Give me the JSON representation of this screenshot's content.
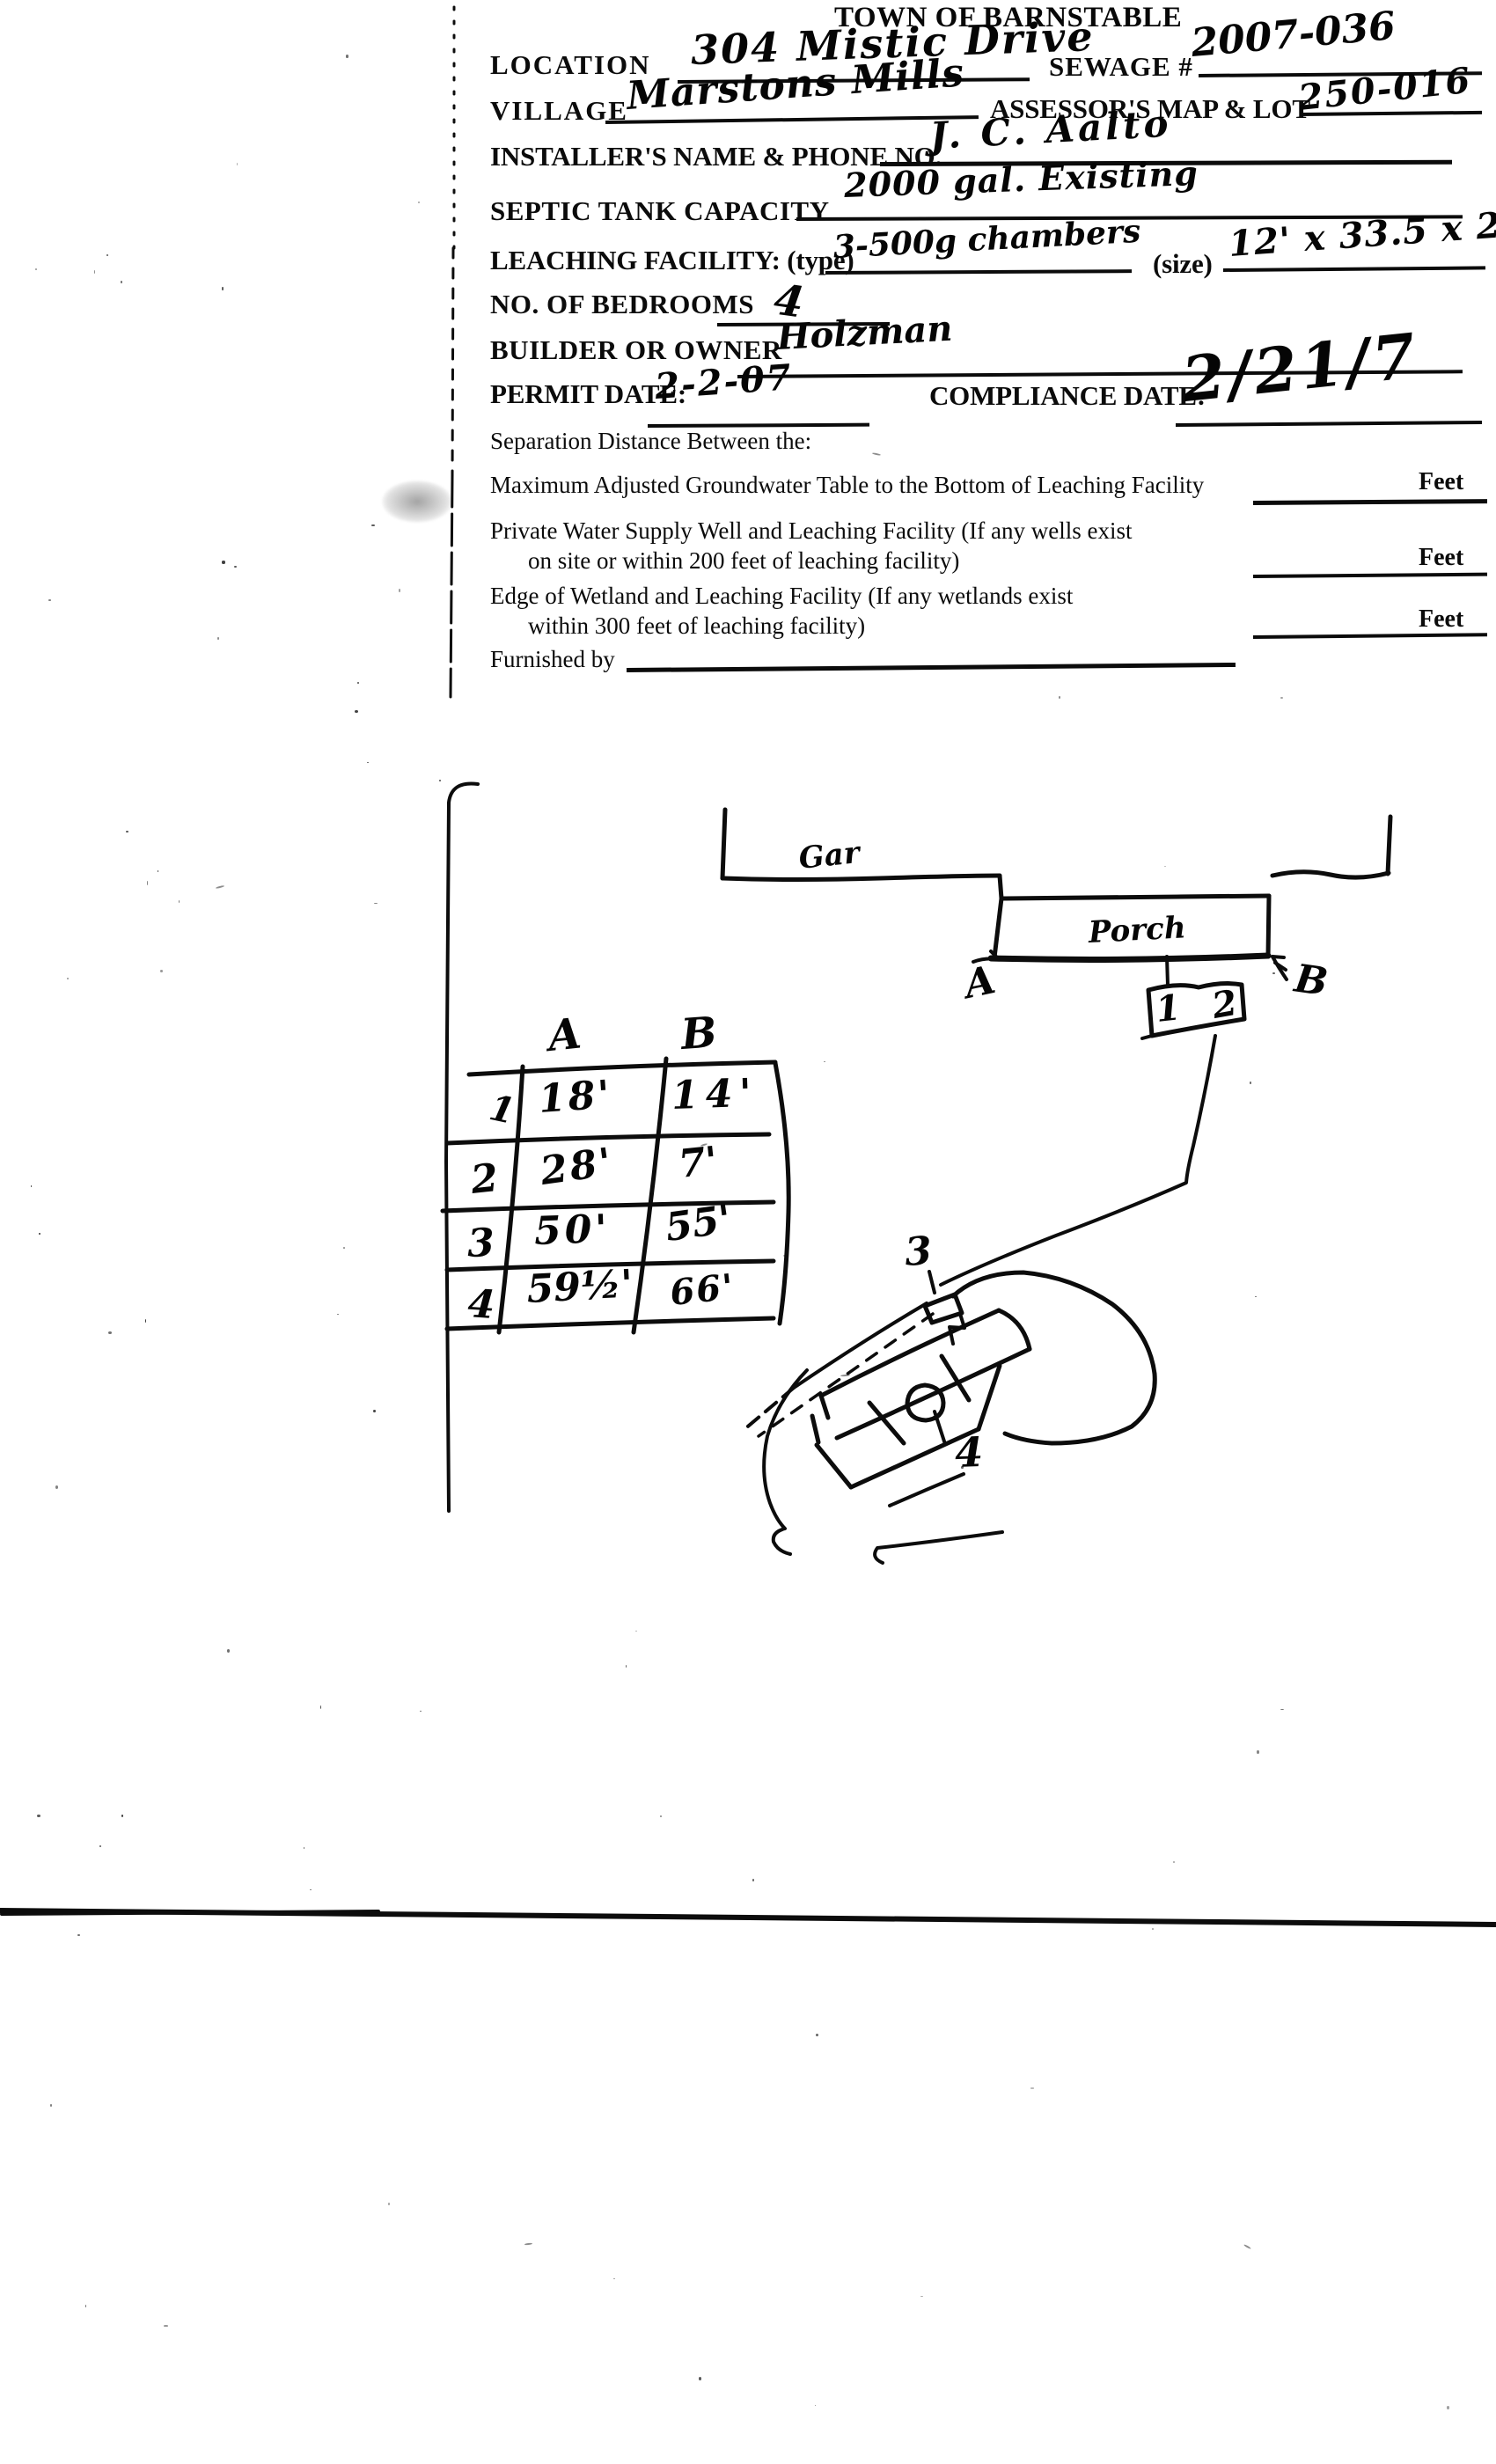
{
  "title": "TOWN OF BARNSTABLE",
  "form": {
    "location": {
      "label": "LOCATION",
      "value": "304 Mistic Drive"
    },
    "sewage": {
      "label": "SEWAGE #",
      "value": "2007-036"
    },
    "village": {
      "label": "VILLAGE",
      "value": "Marstons Mills"
    },
    "assessors_map_lot": {
      "label": "ASSESSOR'S MAP & LOT",
      "value": "250-016"
    },
    "installer": {
      "label": "INSTALLER'S NAME & PHONE NO.",
      "value": "J. C. Aalto"
    },
    "septic_tank_capacity": {
      "label": "SEPTIC TANK CAPACITY",
      "value": "2000 gal. Existing"
    },
    "leaching_facility": {
      "label": "LEACHING FACILITY: (type)",
      "value": "3-500g chambers",
      "size_label": "(size)",
      "size_value": "12' x 33.5 x 2"
    },
    "bedrooms": {
      "label": "NO. OF BEDROOMS",
      "value": "4"
    },
    "builder_or_owner": {
      "label": "BUILDER OR OWNER",
      "value": "Holzman"
    },
    "permit_date": {
      "label": "PERMIT DATE:",
      "value": "2-2-07"
    },
    "compliance_date": {
      "label": "COMPLIANCE DATE:",
      "value": "2/21/7"
    }
  },
  "separation": {
    "heading": "Separation Distance Between the:",
    "groundwater": {
      "line1": "Maximum Adjusted Groundwater Table to the Bottom of Leaching Facility",
      "unit": "Feet"
    },
    "well": {
      "line1": "Private Water Supply Well and Leaching Facility  (If any wells exist",
      "line2": "on site or within 200 feet of leaching facility)",
      "unit": "Feet"
    },
    "wetland": {
      "line1": "Edge of Wetland and Leaching Facility (If any wetlands exist",
      "line2": "within 300 feet of leaching facility)",
      "unit": "Feet"
    },
    "furnished_by_label": "Furnished by"
  },
  "sketch": {
    "garage_label": "Gar",
    "porch_label": "Porch",
    "point_a": "A",
    "point_b": "B",
    "tank_compartment_1": "1",
    "tank_compartment_2": "2",
    "distribution_box_label": "3",
    "leach_field_label": "4",
    "tie_table": {
      "col_a": "A",
      "col_b": "B",
      "rows": [
        {
          "n": "1",
          "a": "18'",
          "b": "14'"
        },
        {
          "n": "2",
          "a": "28'",
          "b": "7'"
        },
        {
          "n": "3",
          "a": "50'",
          "b": "55'"
        },
        {
          "n": "4",
          "a": "59½'",
          "b": "66'"
        }
      ]
    }
  }
}
